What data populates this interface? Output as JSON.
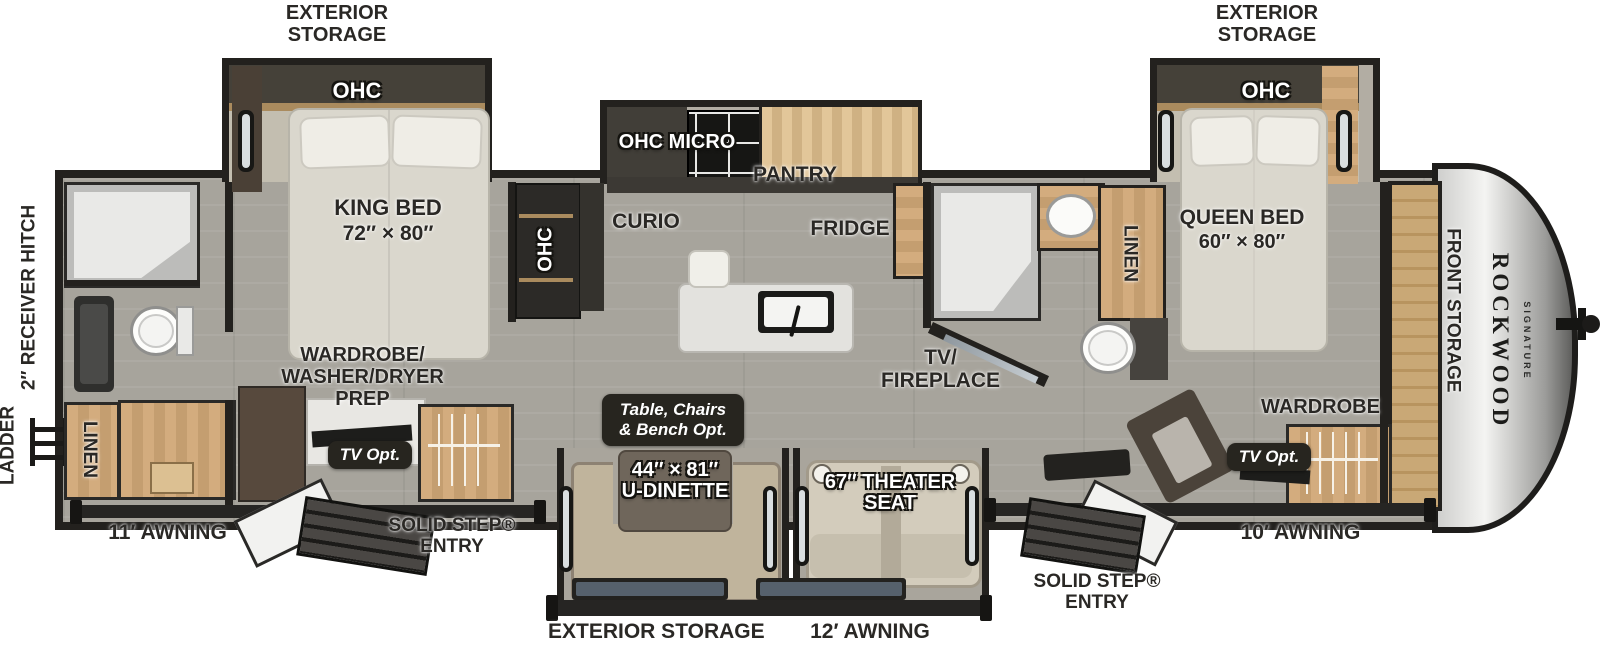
{
  "brand": {
    "name": "ROCKWOOD",
    "series": "SIGNATURE"
  },
  "labels": {
    "exterior_storage": "EXTERIOR STORAGE",
    "ohc": "OHC",
    "ohc_micro": "OHC  MICRO",
    "pantry": "PANTRY",
    "curio": "CURIO",
    "fridge": "FRIDGE",
    "linen": "LINEN",
    "king_bed": "KING BED",
    "king_bed_size": "72″ × 80″",
    "queen_bed": "QUEEN BED",
    "queen_bed_size": "60″ × 80″",
    "wardrobe_prep": [
      "WARDROBE/",
      "WASHER/DRYER",
      "PREP"
    ],
    "tv_opt": "TV Opt.",
    "tv_fireplace": [
      "TV/",
      "FIREPLACE"
    ],
    "table_opt": [
      "Table, Chairs",
      "& Bench  Opt."
    ],
    "dinette_size": "44″ × 81″",
    "dinette": "U-DINETTE",
    "theater_seat": [
      "67″ THEATER",
      "SEAT"
    ],
    "wardrobe": "WARDROBE",
    "front_storage": "FRONT STORAGE",
    "ladder": "LADDER",
    "receiver_hitch": "2″ RECEIVER HITCH",
    "awning_11": "11′ AWNING",
    "awning_10": "10′ AWNING",
    "awning_12": "12′ AWNING",
    "solid_step": [
      "SOLID STEP®",
      "ENTRY"
    ]
  },
  "colors": {
    "wall": "#23211e",
    "floor": "#a7a49c",
    "wood_cabinet": "#cda97c",
    "slide_band": "#454139",
    "badge_bg": "#27251f",
    "mattress": "#dad7cd",
    "front_cap": "#d9d9d7",
    "theater_seat": "#d3ccbc"
  }
}
